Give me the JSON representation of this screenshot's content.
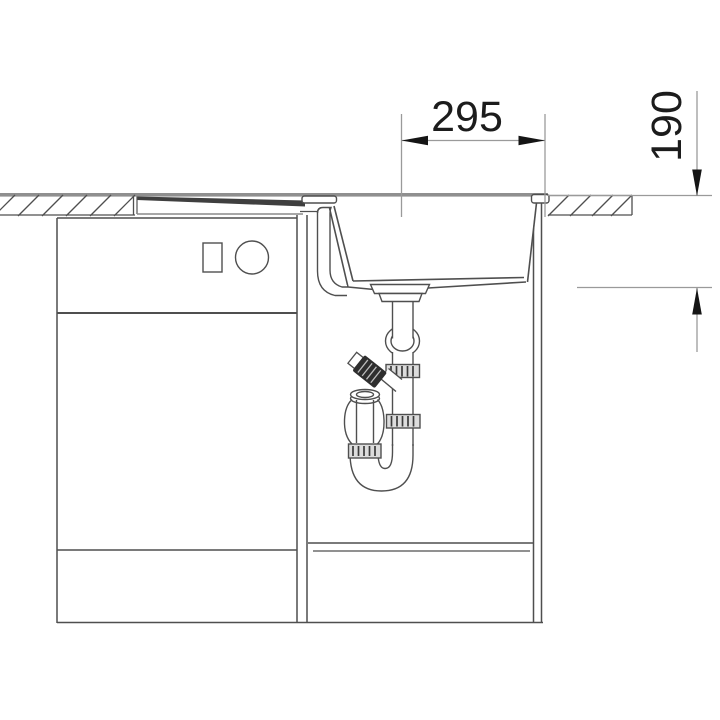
{
  "dimensions": {
    "width": {
      "label": "295"
    },
    "depth": {
      "label": "190"
    }
  },
  "colors": {
    "background": "#ffffff",
    "line": "#4f4f4f",
    "dimension": "#9a9a9a",
    "arrow": "#151515",
    "text": "#1c1c1c",
    "countertop": "#8f8f8f",
    "drainboard": "#3f3f3f",
    "fitting_shade": "#dcdcdc",
    "connector_dark": "#2e2e2e"
  }
}
